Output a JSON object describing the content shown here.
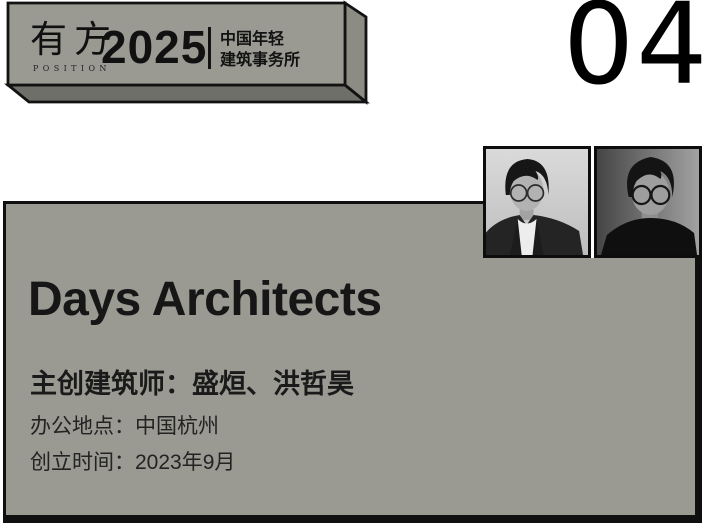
{
  "page": {
    "number": "04",
    "background_color": "#ffffff"
  },
  "banner": {
    "logo": {
      "cn": "有方",
      "en": "POSITION"
    },
    "year": "2025",
    "subtitle": {
      "line1": "中国年轻",
      "line2": "建筑事务所"
    },
    "colors": {
      "front_face": "#9a9a93",
      "side_face": "#8c8c85",
      "bottom_face": "#6f6f69",
      "border": "#121212"
    }
  },
  "card": {
    "title": "Days Architects",
    "lines": [
      {
        "text": "主创建筑师：盛烜、洪哲昊"
      },
      {
        "text": "办公地点：中国杭州"
      },
      {
        "text": "创立时间：2023年9月"
      }
    ],
    "colors": {
      "background": "#9a9a93",
      "border": "#0f0f0f",
      "text": "#1a1a1a"
    }
  }
}
